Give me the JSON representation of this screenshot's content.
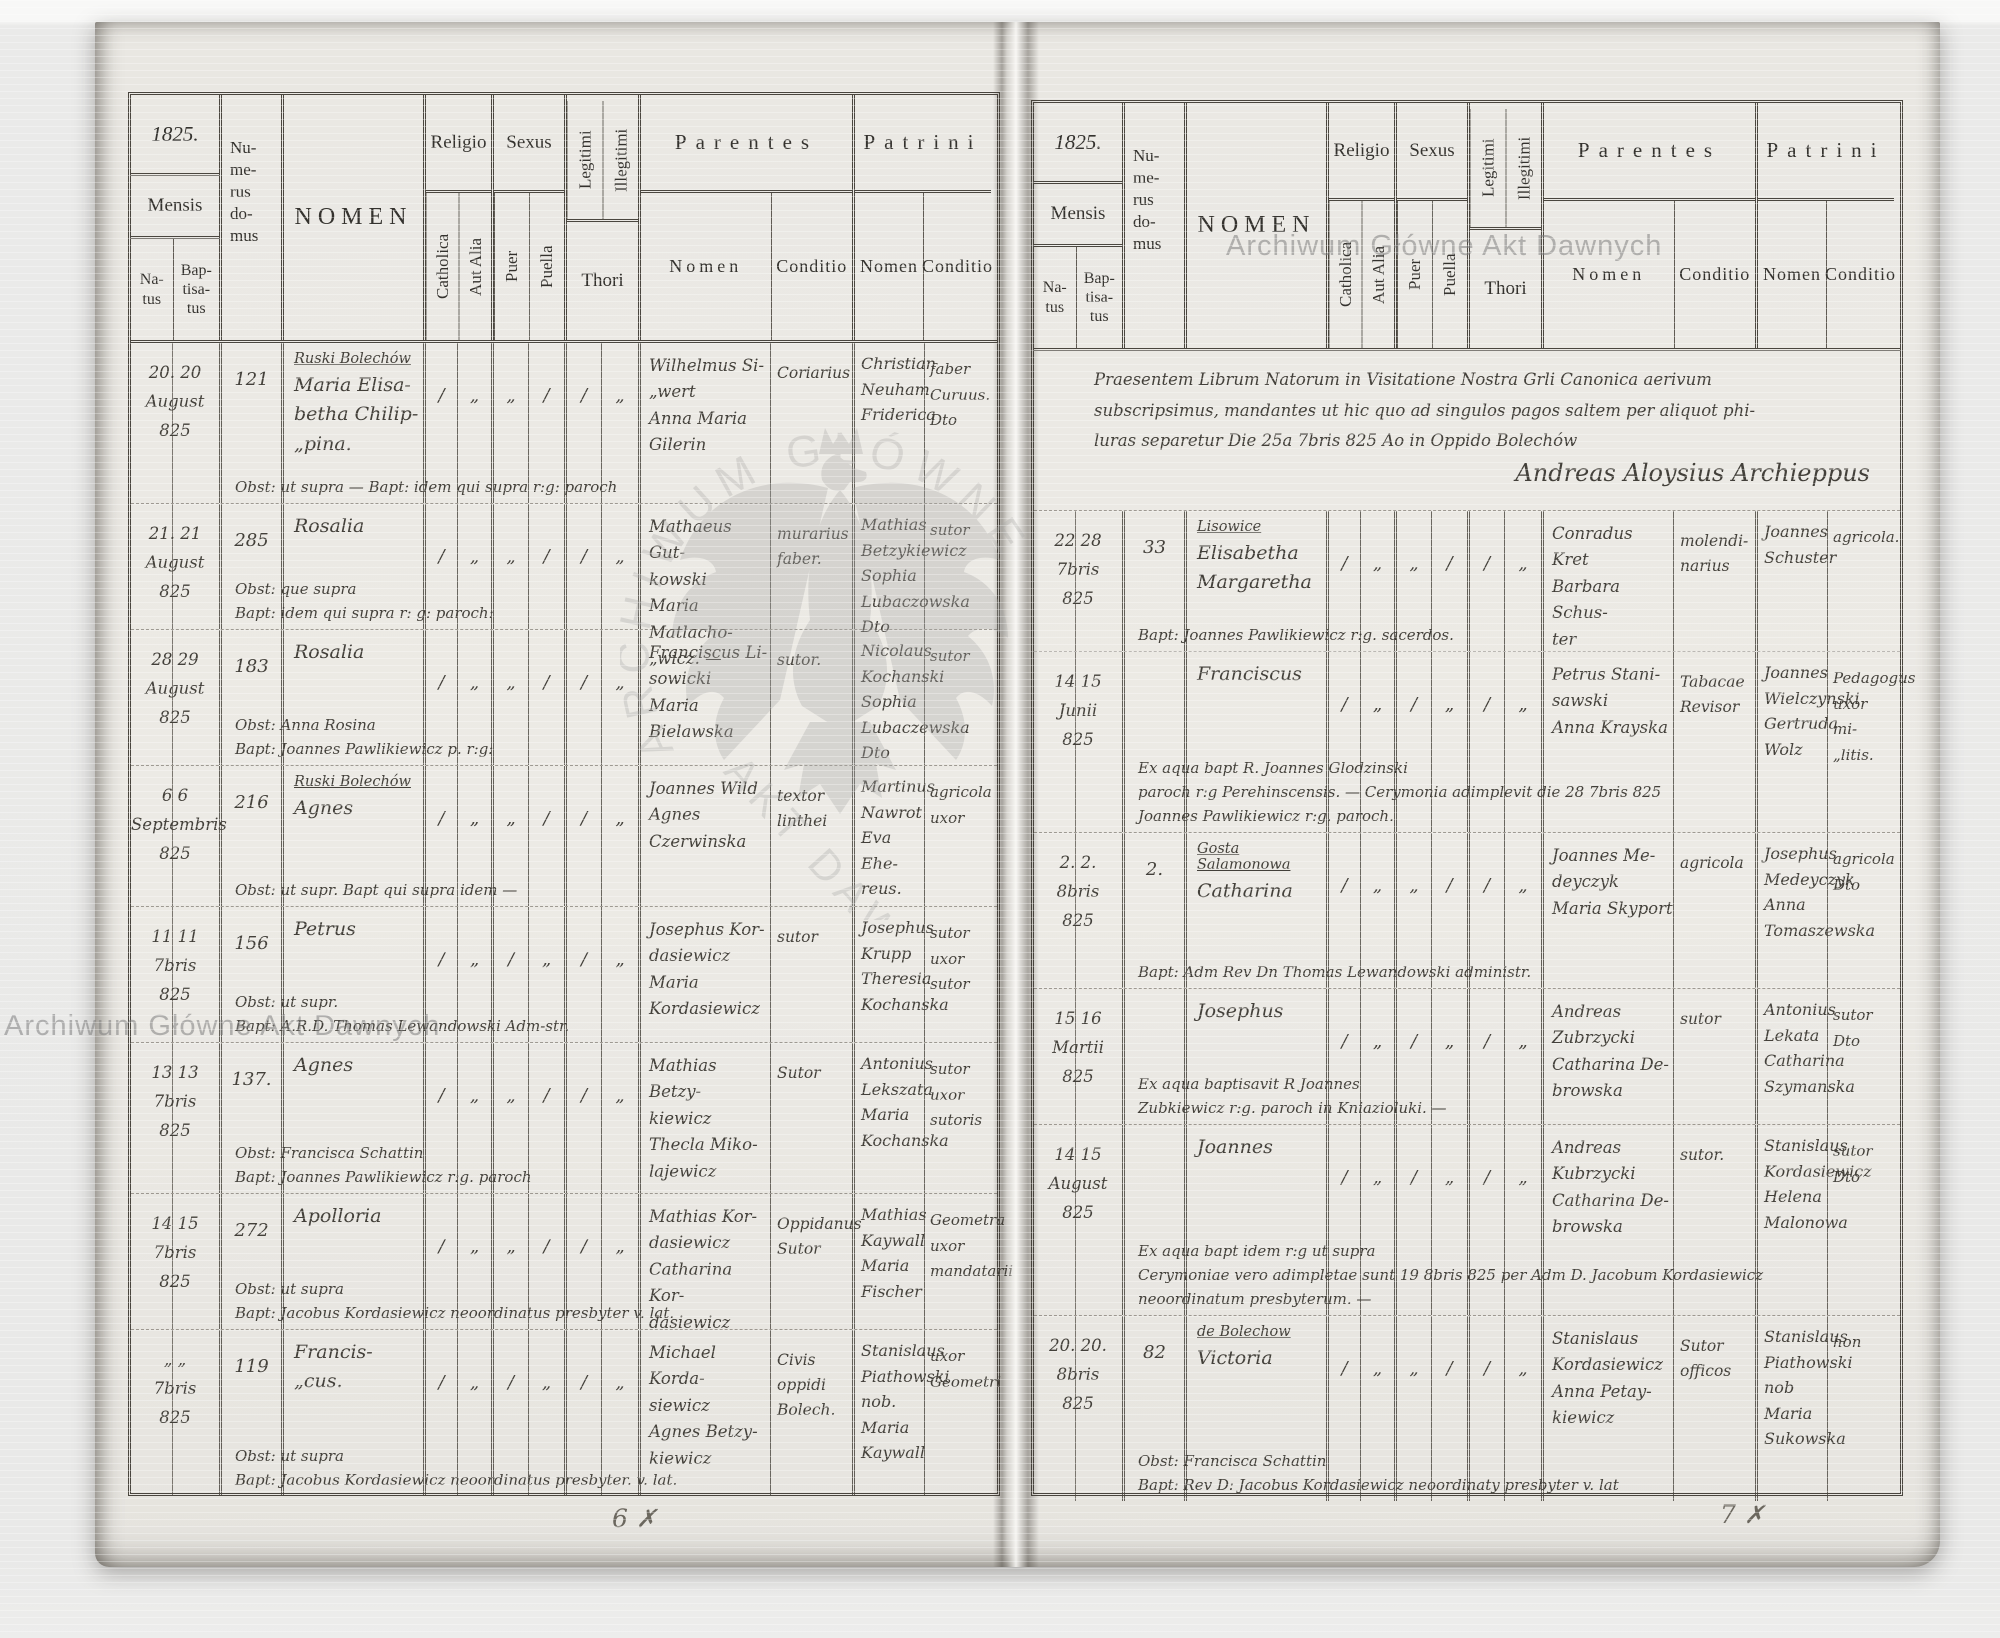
{
  "header_labels": {
    "mensis": "Mensis",
    "natus": "Na-\ntus",
    "baptisatus": "Bap-\ntisa-\ntus",
    "numerus": "Nu-\nme-\nrus\ndo-\nmus",
    "nomen": "NOMEN",
    "religio": "Religio",
    "catholica": "Catholica",
    "aut_alia": "Aut Alia",
    "sexus": "Sexus",
    "puer": "Puer",
    "puella": "Puella",
    "legitimi": "Legitimi",
    "illegitimi": "Illegitimi",
    "thori": "Thori",
    "parentes": "Parentes",
    "patrini": "Patrini",
    "nomen_sub": "Nomen",
    "conditio": "Conditio"
  },
  "left_page": {
    "year": "1825.",
    "page_number": "6 ✗",
    "rows": [
      {
        "dates": "20. 20\nAugust\n825",
        "numerus": "121",
        "place": "Ruski Bolechów",
        "nomen": "Maria Elisa-\nbetha Chilip-\n„pina.",
        "marks": [
          "/",
          "„",
          "„",
          "/",
          "/",
          "„"
        ],
        "parentes_nomen": "Wilhelmus Si-\n„wert\nAnna Maria\nGilerin",
        "parentes_conditio": "Coriarius",
        "patrini_nomen": "Christian\nNeuham\nFriderica",
        "patrini_conditio": "faber\nCuruus.\nDto",
        "note": "Obst: ut supra —   Bapt: idem qui supra r:g: paroch"
      },
      {
        "dates": "21. 21\nAugust\n825",
        "numerus": "285",
        "place": "",
        "nomen": "Rosalia",
        "marks": [
          "/",
          "„",
          "„",
          "/",
          "/",
          "„"
        ],
        "parentes_nomen": "Mathaeus Gut-\nkowski\nMaria Matlacho-\n„wicz. —",
        "parentes_conditio": "murarius\nfaber.",
        "patrini_nomen": "Mathias\nBetzykiewicz\nSophia\nLubaczowska Dto",
        "patrini_conditio": "sutor",
        "note": "Obst: que supra\nBapt: idem qui supra r: g: paroch:"
      },
      {
        "dates": "28 29\nAugust\n825",
        "numerus": "183",
        "place": "",
        "nomen": "Rosalia",
        "marks": [
          "/",
          "„",
          "„",
          "/",
          "/",
          "„"
        ],
        "parentes_nomen": "Franciscus Li-\nsowicki\nMaria Bielawska",
        "parentes_conditio": "sutor.",
        "patrini_nomen": "Nicolaus\nKochanski\nSophia\nLubaczewska Dto",
        "patrini_conditio": "sutor",
        "note": "Obst: Anna Rosina\nBapt: Joannes Pawlikiewicz p. r:g:"
      },
      {
        "dates": "6 6\nSeptembris\n825",
        "numerus": "216",
        "place": "Ruski Bolechów",
        "nomen": "Agnes",
        "marks": [
          "/",
          "„",
          "„",
          "/",
          "/",
          "„"
        ],
        "parentes_nomen": "Joannes Wild\nAgnes Czerwinska",
        "parentes_conditio": "textor\nlinthei",
        "patrini_nomen": "Martinus\nNawrot\nEva Ehe-\nreus.",
        "patrini_conditio": "agricola\nuxor",
        "note": "Obst: ut supr.   Bapt qui supra idem —"
      },
      {
        "dates": "11 11\n7bris\n825",
        "numerus": "156",
        "place": "",
        "nomen": "Petrus",
        "marks": [
          "/",
          "„",
          "/",
          "„",
          "/",
          "„"
        ],
        "parentes_nomen": "Josephus Kor-\ndasiewicz\nMaria Kordasiewicz",
        "parentes_conditio": "sutor",
        "patrini_nomen": "Josephus\nKrupp\nTheresia\nKochanska",
        "patrini_conditio": "sutor\nuxor\nsutor",
        "note": "Obst: ut supr.\nBapt: A.R.D. Thomas Lewandowski Adm-str."
      },
      {
        "dates": "13 13\n7bris\n825",
        "numerus": "137.",
        "place": "",
        "nomen": "Agnes",
        "marks": [
          "/",
          "„",
          "„",
          "/",
          "/",
          "„"
        ],
        "parentes_nomen": "Mathias Betzy-\nkiewicz\nThecla Miko-\nlajewicz",
        "parentes_conditio": "Sutor",
        "patrini_nomen": "Antonius\nLekszata\nMaria\nKochanska",
        "patrini_conditio": "sutor\nuxor\nsutoris",
        "note": "Obst: Francisca Schattin\nBapt: Joannes Pawlikiewicz r:g. paroch"
      },
      {
        "dates": "14 15\n7bris\n825",
        "numerus": "272",
        "place": "",
        "nomen": "Apolloria",
        "marks": [
          "/",
          "„",
          "„",
          "/",
          "/",
          "„"
        ],
        "parentes_nomen": "Mathias Kor-\ndasiewicz\nCatharina Kor-\ndasiewicz",
        "parentes_conditio": "Oppidanus\nSutor",
        "patrini_nomen": "Mathias\nKaywall\nMaria\nFischer",
        "patrini_conditio": "Geometra\nuxor\nmandatarii",
        "note": "Obst: ut supra\nBapt: Jacobus Kordasiewicz neoordinatus presbyter v. lat."
      },
      {
        "dates": "„ „\n7bris\n825",
        "numerus": "119",
        "place": "",
        "nomen": "Francis-\n„cus.",
        "marks": [
          "/",
          "„",
          "/",
          "„",
          "/",
          "„"
        ],
        "parentes_nomen": "Michael Korda-\nsiewicz\nAgnes Betzy-\nkiewicz",
        "parentes_conditio": "Civis\noppidi\nBolech.",
        "patrini_nomen": "Stanislaus\nPiathowski nob.\nMaria\nKaywall",
        "patrini_conditio": "uxor\nGeometri",
        "note": "Obst: ut supra\nBapt: Jacobus Kordasiewicz neoordinatus presbyter. v. lat."
      }
    ]
  },
  "right_page": {
    "year": "1825.",
    "page_number": "7 ✗",
    "prelude": {
      "text": "Praesentem Librum Natorum in Visitatione Nostra Grli Canonica aerivum\nsubscripsimus, mandantes ut hic quo ad singulos pagos saltem per aliquot phi-\nluras separetur Die 25a 7bris 825 Ao in Oppido Bolechów",
      "signature": "Andreas Aloysius Archieppus"
    },
    "rows": [
      {
        "dates": "22 28\n7bris\n825",
        "numerus": "33",
        "place": "Lisowice",
        "nomen": "Elisabetha\nMargaretha",
        "marks": [
          "/",
          "„",
          "„",
          "/",
          "/",
          "„"
        ],
        "parentes_nomen": "Conradus Kret\nBarbara Schus-\nter",
        "parentes_conditio": "molendi-\nnarius",
        "patrini_nomen": "Joannes\nSchuster",
        "patrini_conditio": "agricola.",
        "note": "Bapt: Joannes Pawlikiewicz r:g. sacerdos."
      },
      {
        "dates": "14 15\nJunii\n825",
        "numerus": "",
        "place": "",
        "nomen": "Franciscus",
        "marks": [
          "/",
          "„",
          "/",
          "„",
          "/",
          "„"
        ],
        "parentes_nomen": "Petrus Stani-\nsawski\nAnna Krayska",
        "parentes_conditio": "Tabacae\nRevisor",
        "patrini_nomen": "Joannes\nWielczynski\nGertruda\nWolz",
        "patrini_conditio": "Pedagogus\nuxor mi-\n„litis.",
        "note": "Ex aqua bapt R. Joannes Glodzinski\nparoch r:g Perehinscensis. —   Cerymonia adimplevit die 28 7bris 825\nJoannes Pawlikiewicz r:g. paroch."
      },
      {
        "dates": "2. 2.\n8bris\n825",
        "numerus": "2.",
        "place": "Gosta Salamonowa",
        "nomen": "Catharina",
        "marks": [
          "/",
          "„",
          "„",
          "/",
          "/",
          "„"
        ],
        "parentes_nomen": "Joannes Me-\ndeyczyk\nMaria Skyport",
        "parentes_conditio": "agricola",
        "patrini_nomen": "Josephus\nMedeyczyk\nAnna\nTomaszewska",
        "patrini_conditio": "agricola\nDto",
        "note": "Bapt: Adm Rev Dn Thomas Lewandowski administr."
      },
      {
        "dates": "15 16\nMartii\n825",
        "numerus": "",
        "place": "",
        "nomen": "Josephus",
        "marks": [
          "/",
          "„",
          "/",
          "„",
          "/",
          "„"
        ],
        "parentes_nomen": "Andreas Zubrzycki\nCatharina De-\nbrowska",
        "parentes_conditio": "sutor",
        "patrini_nomen": "Antonius\nLekata\nCatharina\nSzymanska",
        "patrini_conditio": "sutor\nDto",
        "note": "Ex aqua baptisavit R Joannes\nZubkiewicz r:g. paroch in Kniazioluki. —"
      },
      {
        "dates": "14 15\nAugust\n825",
        "numerus": "",
        "place": "",
        "nomen": "Joannes",
        "marks": [
          "/",
          "„",
          "/",
          "„",
          "/",
          "„"
        ],
        "parentes_nomen": "Andreas Kubrzycki\nCatharina De-\nbrowska",
        "parentes_conditio": "sutor.",
        "patrini_nomen": "Stanislaus\nKordasiewicz\nHelena\nMalonowa",
        "patrini_conditio": "sutor\nDto",
        "note": "Ex aqua bapt idem r:g ut supra\nCerymoniae vero adimpletae sunt 19 8bris 825 per Adm D. Jacobum Kordasiewicz\nneoordinatum presbyterum. —"
      },
      {
        "dates": "20. 20.\n8bris\n825",
        "numerus": "82",
        "place": "de Bolechow",
        "nomen": "Victoria",
        "marks": [
          "/",
          "„",
          "„",
          "/",
          "/",
          "„"
        ],
        "parentes_nomen": "Stanislaus\nKordasiewicz\nAnna Petay-\nkiewicz",
        "parentes_conditio": "Sutor\nofficos",
        "patrini_nomen": "Stanislaus\nPiathowski nob\nMaria\nSukowska",
        "patrini_conditio": "hon",
        "note": "Obst: Francisca Schattin\nBapt: Rev D: Jacobus Kordasiewicz neoordinaty presbyter v. lat"
      }
    ]
  },
  "watermarks": {
    "text_top_right": "Archiwum Główne Akt Dawnych",
    "text_bottom_left": "Archiwum Główne Akt Dawnych",
    "center_arc_text": "ARCHIWUM GŁÓWNE",
    "center_diag_text": "AKT DAWNYCH"
  }
}
